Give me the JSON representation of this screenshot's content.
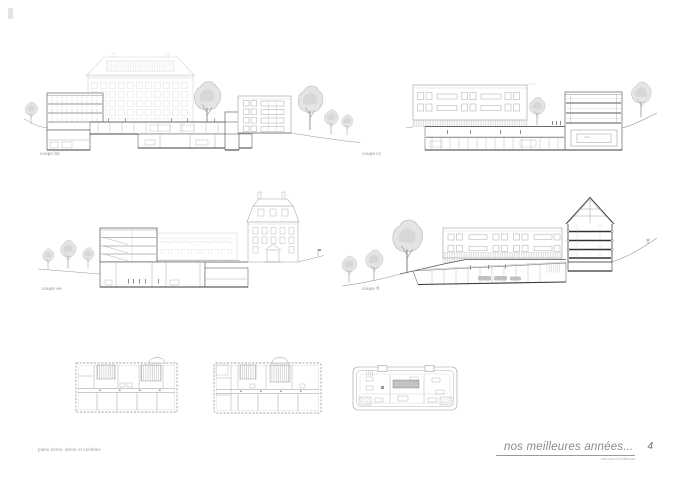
{
  "sheet": {
    "title_block": {
      "title": "nos meilleures années...",
      "subtitle": "concours d'architecture",
      "sheet_number": "4"
    },
    "plans_caption": "plans 2ème, 3ème et combles",
    "sections": {
      "bb": {
        "label": "coupe bb"
      },
      "cc": {
        "label": "coupe cc"
      },
      "ee": {
        "label": "coupe ee"
      },
      "ff": {
        "label": "coupe ff"
      }
    },
    "colors": {
      "paper": "#ffffff",
      "ink": "#6f6f6f",
      "ink_dark": "#3a3a3a",
      "ink_faint": "#d6d6d6",
      "tree": "#c6c6c6",
      "label_text": "#8c8c8c"
    }
  }
}
